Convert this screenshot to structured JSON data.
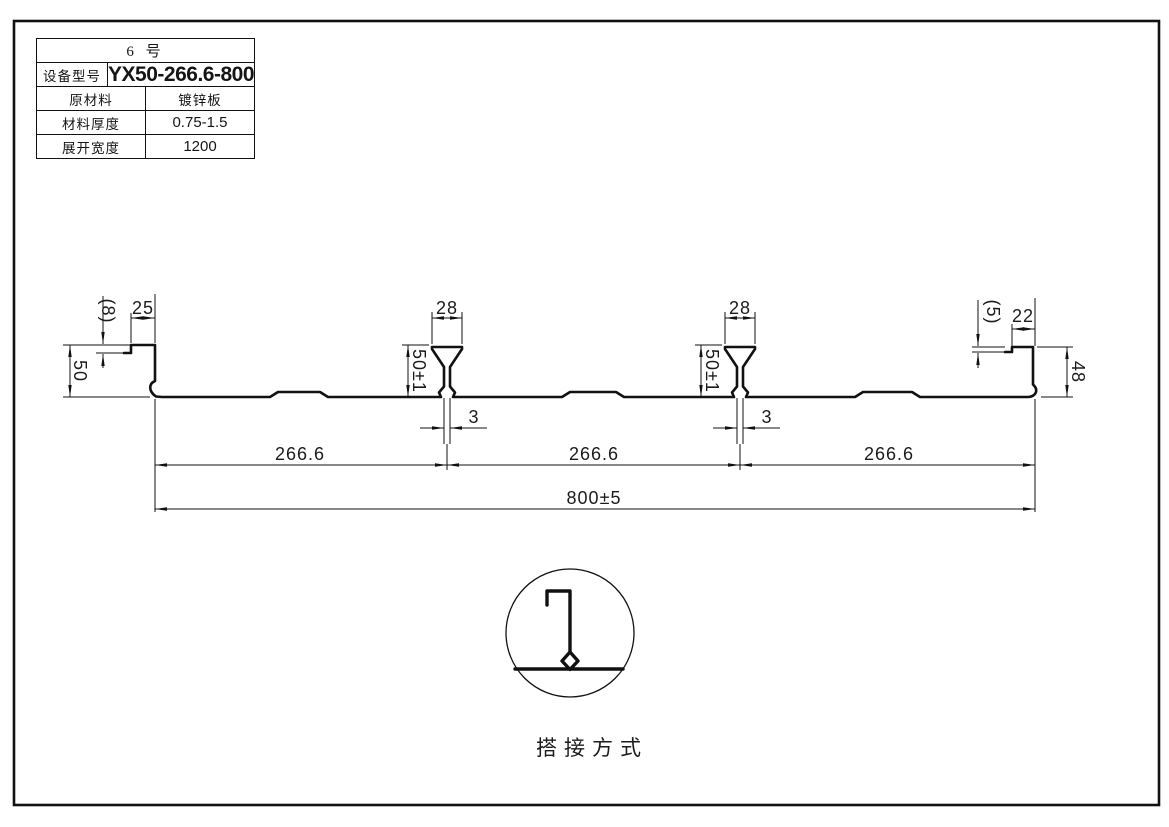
{
  "table": {
    "title": "6 号",
    "rows": [
      {
        "label": "设备型号",
        "value": "YX50-266.6-800"
      },
      {
        "label": "原材料",
        "value": "镀锌板"
      },
      {
        "label": "材料厚度",
        "value": "0.75-1.5"
      },
      {
        "label": "展开宽度",
        "value": "1200"
      }
    ]
  },
  "dimensions": {
    "left_lip": "(8)",
    "left_flange": "25",
    "left_height": "50",
    "rib_top_width": "28",
    "rib_height": "50±1",
    "rib_stem": "3",
    "pitch_1": "266.6",
    "pitch_2": "266.6",
    "pitch_3": "266.6",
    "overall_width": "800±5",
    "right_flange": "22",
    "right_lip": "(5)",
    "right_height": "48"
  },
  "detail": {
    "caption": "搭接方式"
  },
  "colors": {
    "line": "#111111",
    "background": "#ffffff"
  }
}
